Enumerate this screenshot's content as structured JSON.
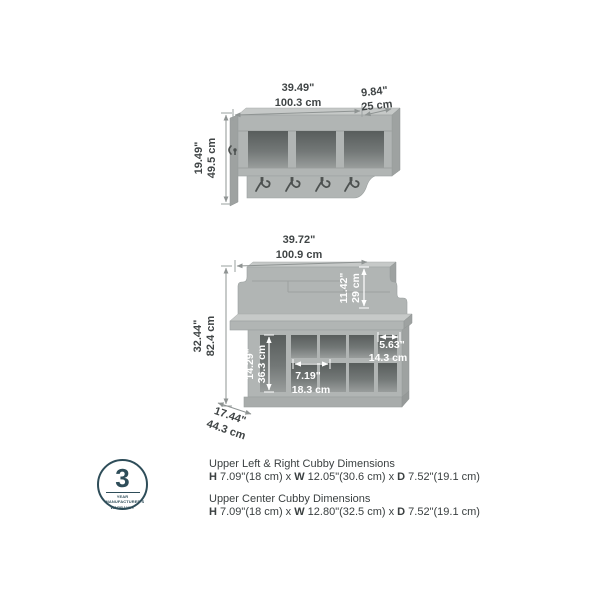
{
  "colors": {
    "furniture_gray": "#b1b5b4",
    "furniture_gray_dark": "#9ea2a1",
    "cubby_interior": "#5f6463",
    "dimension_text": "#404546",
    "badge_teal": "#2e4d59",
    "background": "#ffffff"
  },
  "shelf": {
    "width_in": "39.49\"",
    "width_cm": "100.3 cm",
    "depth_in": "9.84\"",
    "depth_cm": "25 cm",
    "height_in": "19.49\"",
    "height_cm": "49.5 cm"
  },
  "bench": {
    "width_in": "39.72\"",
    "width_cm": "100.9 cm",
    "backrest_height_in": "11.42\"",
    "backrest_height_cm": "29 cm",
    "height_in": "32.44\"",
    "height_cm": "82.4 cm",
    "left_cubby_height_in": "14.29\"",
    "left_cubby_height_cm": "36.3 cm",
    "center_cubby_width_in": "7.19\"",
    "center_cubby_width_cm": "18.3 cm",
    "right_cubby_width_in": "5.63\"",
    "right_cubby_width_cm": "14.3 cm",
    "depth_in": "17.44\"",
    "depth_cm": "44.3 cm"
  },
  "warranty_badge": {
    "number": "3",
    "line1": "YEAR MANUFACTURER'S",
    "line2": "WARRANTY"
  },
  "notes": [
    {
      "title": "Upper Left & Right Cubby Dimensions",
      "h_label": "H",
      "h_value": " 7.09\"(18 cm) x ",
      "w_label": "W",
      "w_value": " 12.05\"(30.6 cm) x ",
      "d_label": "D",
      "d_value": " 7.52\"(19.1 cm)"
    },
    {
      "title": "Upper Center Cubby Dimensions",
      "h_label": "H",
      "h_value": " 7.09\"(18 cm) x ",
      "w_label": "W",
      "w_value": " 12.80\"(32.5 cm) x ",
      "d_label": "D",
      "d_value": " 7.52\"(19.1 cm)"
    }
  ]
}
